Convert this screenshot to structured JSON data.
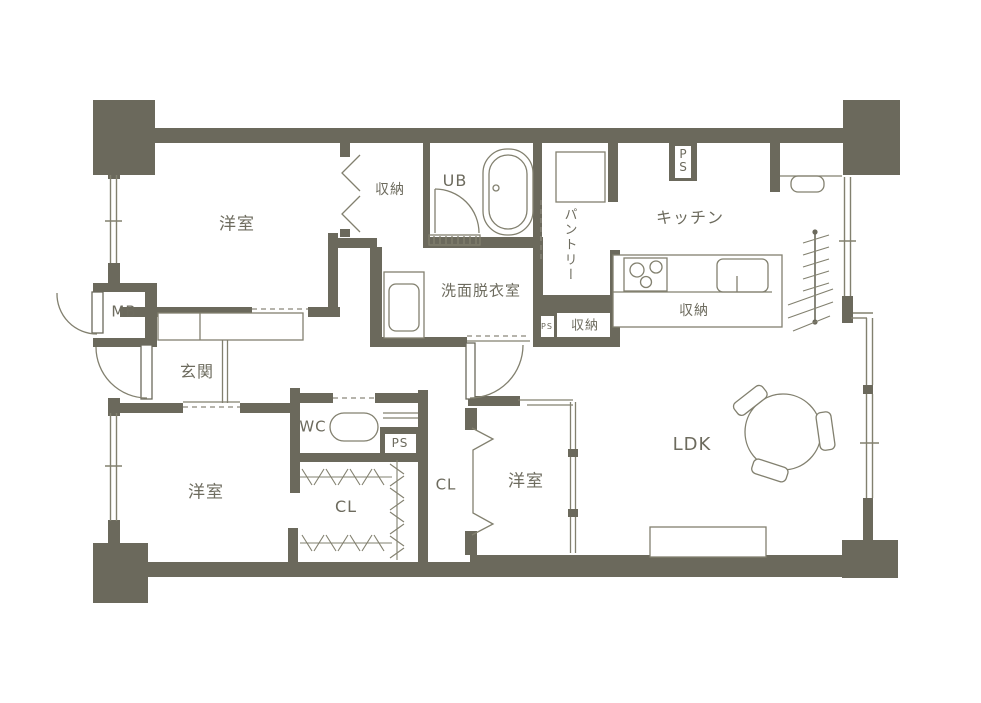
{
  "labels": {
    "bedroom_nw": "洋室",
    "bedroom_sw": "洋室",
    "bedroom_s": "洋室",
    "ldk": "LDK",
    "kitchen": "キッチン",
    "pantry": "パントリー",
    "washroom": "洗面脱衣室",
    "unit_bath": "UB",
    "toilet_room": "WC",
    "entrance": "玄関",
    "meter_box": "MB",
    "storage_nw": "収納",
    "storage_hall": "収納",
    "storage_counter": "収納",
    "closet_walkin": "CL",
    "closet_s": "CL",
    "pipe_shaft_top": "PS",
    "pipe_shaft_mid": "PS",
    "pipe_shaft_wc": "PS"
  },
  "colors": {
    "wall": "#6b695c",
    "line": "#82806f",
    "dash": "#8a887b",
    "text": "#6d6b5e",
    "background": "#ffffff"
  }
}
